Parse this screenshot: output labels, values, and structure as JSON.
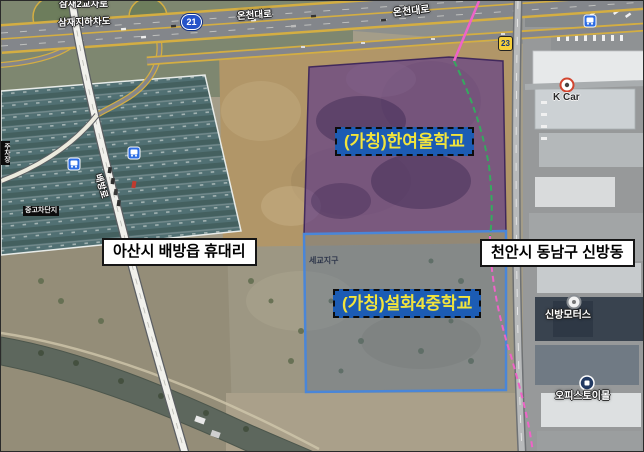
{
  "map": {
    "type": "satellite-annotated",
    "site_overlays": [
      {
        "name": "hanyeoul-school-site",
        "label": "(가칭)한여울학교",
        "fill_color": "#58348c",
        "label_bg": "#1c5cb4",
        "label_text_color": "#f2e43c"
      },
      {
        "name": "seolhwa4-middle-school-site",
        "label": "(가칭)설화4중학교",
        "fill_color": "#46618f",
        "border_color": "#4a86d8",
        "label_bg": "#1c5cb4",
        "label_text_color": "#f2e43c"
      }
    ],
    "admin_labels": [
      {
        "text": "아산시 배방읍 휴대리"
      },
      {
        "text": "천안시 동남구 신방동"
      }
    ],
    "road_labels": [
      {
        "text": "삼재2교차로"
      },
      {
        "text": "삼재지하차도"
      },
      {
        "text": "온천대로"
      },
      {
        "text": "온천대로"
      },
      {
        "text": "배방로"
      }
    ],
    "poi_labels": [
      {
        "text": "K Car"
      },
      {
        "text": "신방모터스"
      },
      {
        "text": "오피스토이몰"
      },
      {
        "text": "중고차단지"
      },
      {
        "text": "주차장"
      },
      {
        "text": "세교지구"
      }
    ],
    "route_shields": [
      {
        "type": "national-route",
        "number": "21"
      },
      {
        "type": "local-route",
        "number": "23"
      }
    ],
    "boundary_colors": {
      "green": "#35a95f",
      "pink": "#ef63c8"
    }
  }
}
